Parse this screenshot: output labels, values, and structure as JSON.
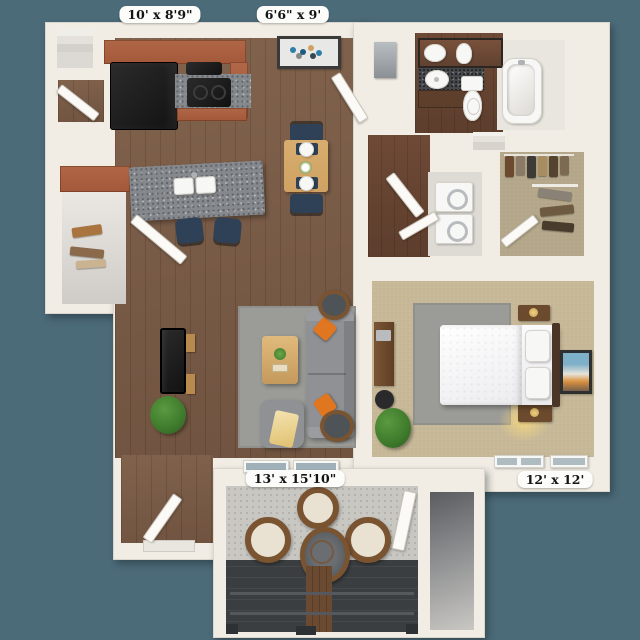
{
  "plan": {
    "labels": {
      "kitchen": "10' x 8'9\"",
      "dining": "6'6\" x 9'",
      "patio": "13' x 15'10\"",
      "bedroom": "12' x 12'"
    }
  },
  "colors": {
    "bg": "#4c6b79",
    "wall": "#f1ede5",
    "wood": "#7d5e47",
    "wood-dark": "#6b4e3a",
    "tile": "#6e4a36",
    "carpet": "#c6b897",
    "closet-carpet": "#b3a689",
    "rug": "#9b9b97",
    "granite": "#85888c",
    "cabinet": "#a3583a",
    "sofa": "#8f9195",
    "orange": "#e0761f",
    "chair-blue": "#2e4156",
    "table-wood": "#cfa263",
    "plant": "#3e7a2c",
    "concrete": "#c8c7c2",
    "deck": "#3b3e41",
    "wicker": "#7a5331",
    "cushion": "#e9e2d2",
    "fixture": "#f7f7f5",
    "label-bg": "#fcfcfa",
    "label-text": "#141414"
  }
}
